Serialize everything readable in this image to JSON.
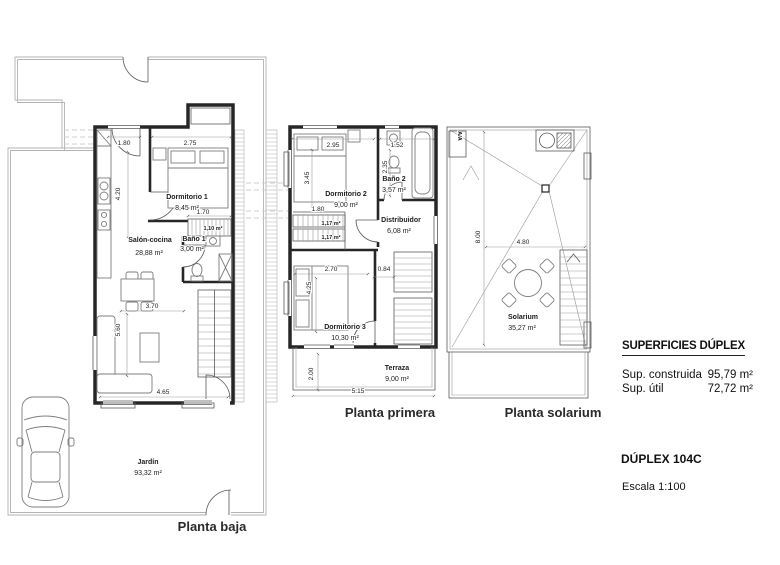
{
  "plans": {
    "baja": {
      "label": "Planta baja",
      "rooms": {
        "dormitorio1": {
          "name": "Dormitorio 1",
          "area": "8,45 m²"
        },
        "bano1": {
          "name": "Baño 1",
          "area": "3,00 m²"
        },
        "salon": {
          "name": "Salón-cocina",
          "area": "28,88 m²"
        },
        "jardin": {
          "name": "Jardín",
          "area": "93,32 m²"
        }
      },
      "stair_area": "1,10 m²",
      "dims": {
        "door": "1.80",
        "dorm": "2.75",
        "kitchen": "4.20",
        "stair": "1.70",
        "salon_w": "3.70",
        "salon_h": "5.60",
        "facade": "4.65"
      }
    },
    "primera": {
      "label": "Planta primera",
      "rooms": {
        "dormitorio2": {
          "name": "Dormitorio 2",
          "area": "9,00 m²"
        },
        "bano2": {
          "name": "Baño 2",
          "area": "3,57 m²"
        },
        "distribuidor": {
          "name": "Distribuidor",
          "area": "6,08 m²"
        },
        "dormitorio3": {
          "name": "Dormitorio 3",
          "area": "10,30 m²"
        },
        "terraza": {
          "name": "Terraza",
          "area": "9,00 m²"
        }
      },
      "stair_area_a": "1,17 m²",
      "stair_area_b": "1,17 m²",
      "dims": {
        "dorm2_w": "2.95",
        "bano2_w": "1.52",
        "dorm2_h": "3.45",
        "bano2_h": "2.35",
        "stair": "1.80",
        "dorm3_w": "2.70",
        "hall": "0.84",
        "dorm3_h": "4.25",
        "terraza_h": "2.00",
        "facade": "5.15"
      }
    },
    "solarium": {
      "label": "Planta solarium",
      "rooms": {
        "solarium": {
          "name": "Solarium",
          "area": "35,27 m²"
        }
      },
      "ac_label": "A/A",
      "dims": {
        "depth": "8.00",
        "width": "4.80"
      }
    }
  },
  "info": {
    "title": "SUPERFICIES DÚPLEX",
    "rows": [
      {
        "label": "Sup. construida",
        "value": "95,79 m²"
      },
      {
        "label": "Sup. útil",
        "value": "72,72 m²"
      }
    ],
    "unit_name": "DÚPLEX 104C",
    "scale": "Escala 1:100"
  },
  "colors": {
    "wall": "#262626",
    "thin": "#5a5a5a",
    "boundary": "#b3b3b3",
    "text": "#1c1c1c"
  }
}
